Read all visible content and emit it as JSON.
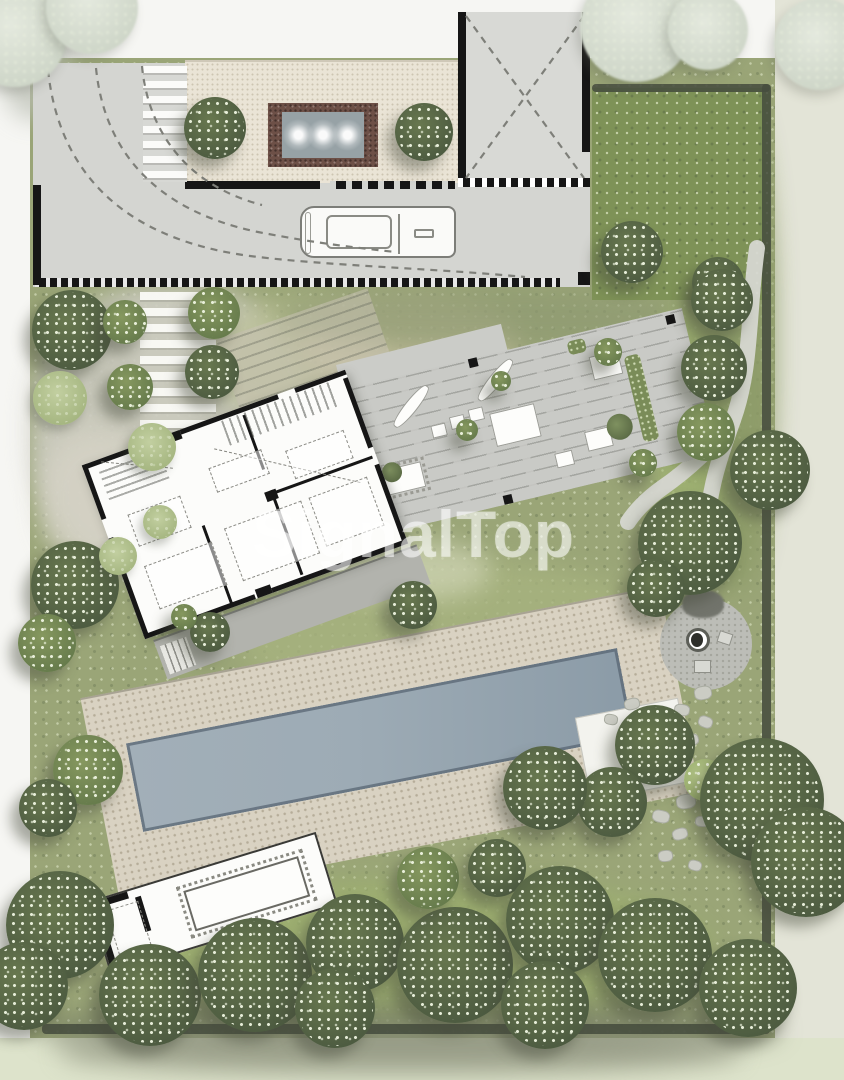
{
  "watermark": {
    "text": "SignalTop"
  },
  "colors": {
    "paper": "#f6f6f3",
    "margin_right": "#e3e4d7",
    "margin_bottom": "#dde3cb",
    "garden": "#9aa577",
    "lawn": "#7e9257",
    "hedge": "#474d3f",
    "concrete": "#d4d5d1",
    "pebble": "#eae4d6",
    "deck": "#c9cac6",
    "terrace": "#b2b3ad",
    "pool_deck": "#d9d2c2",
    "pool_water": "#9dabb5",
    "structure_white": "#fcfcfa",
    "wall": "#161616",
    "water_border": "#6d5047",
    "water": "#97a2a6",
    "stone": "#cbccc4",
    "tree_dark": "#56644a",
    "tree_mid": "#75865c",
    "tree_light": "#a9ba85",
    "tree_sage": "#b3c192",
    "tree_pale": "#d9dfd2",
    "watermark": "rgba(255,255,255,0.55)"
  },
  "features": {
    "trees": [
      {
        "x": 15,
        "y": 35,
        "r": 52,
        "t": "pale"
      },
      {
        "x": 92,
        "y": 8,
        "r": 46,
        "t": "pale"
      },
      {
        "x": 636,
        "y": 26,
        "r": 56,
        "t": "pale"
      },
      {
        "x": 708,
        "y": 30,
        "r": 40,
        "t": "pale"
      },
      {
        "x": 820,
        "y": 44,
        "r": 46,
        "t": "pale"
      },
      {
        "x": 215,
        "y": 128,
        "r": 31,
        "t": "dark"
      },
      {
        "x": 424,
        "y": 132,
        "r": 29,
        "t": "dark"
      },
      {
        "x": 632,
        "y": 252,
        "r": 31,
        "t": "dark"
      },
      {
        "x": 718,
        "y": 283,
        "r": 26,
        "t": "dark"
      },
      {
        "x": 72,
        "y": 330,
        "r": 40,
        "t": "dark"
      },
      {
        "x": 125,
        "y": 322,
        "r": 22,
        "t": "mid"
      },
      {
        "x": 214,
        "y": 313,
        "r": 26,
        "t": "mid"
      },
      {
        "x": 212,
        "y": 372,
        "r": 27,
        "t": "dark"
      },
      {
        "x": 130,
        "y": 387,
        "r": 23,
        "t": "mid"
      },
      {
        "x": 60,
        "y": 398,
        "r": 27,
        "t": "sage"
      },
      {
        "x": 152,
        "y": 447,
        "r": 24,
        "t": "sage"
      },
      {
        "x": 75,
        "y": 585,
        "r": 44,
        "t": "dark"
      },
      {
        "x": 47,
        "y": 643,
        "r": 29,
        "t": "mid"
      },
      {
        "x": 160,
        "y": 522,
        "r": 17,
        "t": "sage"
      },
      {
        "x": 118,
        "y": 556,
        "r": 19,
        "t": "sage"
      },
      {
        "x": 501,
        "y": 381,
        "r": 10,
        "t": "mid"
      },
      {
        "x": 608,
        "y": 352,
        "r": 14,
        "t": "mid"
      },
      {
        "x": 643,
        "y": 463,
        "r": 14,
        "t": "mid"
      },
      {
        "x": 467,
        "y": 430,
        "r": 11,
        "t": "mid"
      },
      {
        "x": 413,
        "y": 605,
        "r": 24,
        "t": "dark"
      },
      {
        "x": 210,
        "y": 632,
        "r": 20,
        "t": "dark"
      },
      {
        "x": 184,
        "y": 617,
        "r": 13,
        "t": "mid"
      },
      {
        "x": 722,
        "y": 300,
        "r": 31,
        "t": "dark"
      },
      {
        "x": 714,
        "y": 368,
        "r": 33,
        "t": "dark"
      },
      {
        "x": 706,
        "y": 432,
        "r": 29,
        "t": "mid"
      },
      {
        "x": 770,
        "y": 470,
        "r": 40,
        "t": "dark"
      },
      {
        "x": 690,
        "y": 543,
        "r": 52,
        "t": "dark"
      },
      {
        "x": 656,
        "y": 588,
        "r": 29,
        "t": "dark"
      },
      {
        "x": 655,
        "y": 745,
        "r": 40,
        "t": "dark"
      },
      {
        "x": 612,
        "y": 802,
        "r": 35,
        "t": "dark"
      },
      {
        "x": 545,
        "y": 788,
        "r": 42,
        "t": "dark"
      },
      {
        "x": 705,
        "y": 780,
        "r": 21,
        "t": "light"
      },
      {
        "x": 762,
        "y": 800,
        "r": 62,
        "t": "dark"
      },
      {
        "x": 806,
        "y": 862,
        "r": 55,
        "t": "dark"
      },
      {
        "x": 88,
        "y": 770,
        "r": 35,
        "t": "mid"
      },
      {
        "x": 48,
        "y": 808,
        "r": 29,
        "t": "dark"
      },
      {
        "x": 60,
        "y": 925,
        "r": 54,
        "t": "dark"
      },
      {
        "x": 24,
        "y": 986,
        "r": 44,
        "t": "dark"
      },
      {
        "x": 150,
        "y": 995,
        "r": 51,
        "t": "dark"
      },
      {
        "x": 255,
        "y": 975,
        "r": 57,
        "t": "dark"
      },
      {
        "x": 355,
        "y": 943,
        "r": 49,
        "t": "dark"
      },
      {
        "x": 335,
        "y": 1008,
        "r": 40,
        "t": "dark"
      },
      {
        "x": 455,
        "y": 965,
        "r": 58,
        "t": "dark"
      },
      {
        "x": 428,
        "y": 878,
        "r": 31,
        "t": "mid"
      },
      {
        "x": 497,
        "y": 868,
        "r": 29,
        "t": "dark"
      },
      {
        "x": 560,
        "y": 920,
        "r": 54,
        "t": "dark"
      },
      {
        "x": 545,
        "y": 1005,
        "r": 44,
        "t": "dark"
      },
      {
        "x": 655,
        "y": 955,
        "r": 57,
        "t": "dark"
      },
      {
        "x": 748,
        "y": 988,
        "r": 49,
        "t": "dark"
      }
    ],
    "patches": [
      {
        "x": 30,
        "y": 285,
        "w": 280,
        "h": 290,
        "c": "#cdccc2",
        "o": 0.9
      },
      {
        "x": 40,
        "y": 430,
        "w": 120,
        "h": 140,
        "c": "#d6d3c6",
        "o": 0.8
      },
      {
        "x": 210,
        "y": 300,
        "w": 180,
        "h": 120,
        "c": "#b9bf93",
        "o": 0.7
      },
      {
        "x": 300,
        "y": 300,
        "w": 220,
        "h": 90,
        "c": "#cfc5a9",
        "o": 0.6
      },
      {
        "x": 280,
        "y": 288,
        "w": 420,
        "h": 60,
        "c": "#8f9a72",
        "o": 0.7
      },
      {
        "x": 240,
        "y": 560,
        "w": 420,
        "h": 150,
        "c": "#a7b37f",
        "o": 0.8
      },
      {
        "x": 150,
        "y": 880,
        "w": 560,
        "h": 140,
        "c": "#9db06f",
        "o": 0.8
      },
      {
        "x": 330,
        "y": 540,
        "w": 160,
        "h": 60,
        "c": "#d8dcc0",
        "o": 0.6
      },
      {
        "x": 690,
        "y": 90,
        "w": 85,
        "h": 500,
        "c": "#8b9a66",
        "o": 0.8
      },
      {
        "x": 655,
        "y": 300,
        "w": 60,
        "h": 300,
        "c": "#9fb470",
        "o": 0.7
      },
      {
        "x": 40,
        "y": 1000,
        "w": 740,
        "h": 60,
        "c": "#6f7560",
        "o": 0.55
      },
      {
        "x": 60,
        "y": 1030,
        "w": 680,
        "h": 45,
        "c": "#8d917c",
        "o": 0.6
      },
      {
        "x": 0,
        "y": 0,
        "w": 70,
        "h": 120,
        "c": "#b9bdb2",
        "o": 0.7
      }
    ],
    "stones": [
      {
        "x": 694,
        "y": 686,
        "w": 18,
        "h": 14,
        "rot": -10
      },
      {
        "x": 674,
        "y": 704,
        "w": 16,
        "h": 12,
        "rot": 8
      },
      {
        "x": 698,
        "y": 716,
        "w": 15,
        "h": 12,
        "rot": 20
      },
      {
        "x": 684,
        "y": 734,
        "w": 15,
        "h": 12,
        "rot": -14
      },
      {
        "x": 664,
        "y": 750,
        "w": 14,
        "h": 11,
        "rot": 6
      },
      {
        "x": 676,
        "y": 794,
        "w": 20,
        "h": 15,
        "rot": -8
      },
      {
        "x": 652,
        "y": 810,
        "w": 18,
        "h": 13,
        "rot": 12
      },
      {
        "x": 672,
        "y": 828,
        "w": 16,
        "h": 12,
        "rot": -16
      },
      {
        "x": 695,
        "y": 816,
        "w": 14,
        "h": 11,
        "rot": 4
      },
      {
        "x": 658,
        "y": 850,
        "w": 15,
        "h": 12,
        "rot": -6
      },
      {
        "x": 688,
        "y": 860,
        "w": 14,
        "h": 11,
        "rot": 14
      },
      {
        "x": 624,
        "y": 698,
        "w": 16,
        "h": 12,
        "rot": -12
      },
      {
        "x": 604,
        "y": 714,
        "w": 14,
        "h": 11,
        "rot": 10
      }
    ]
  }
}
